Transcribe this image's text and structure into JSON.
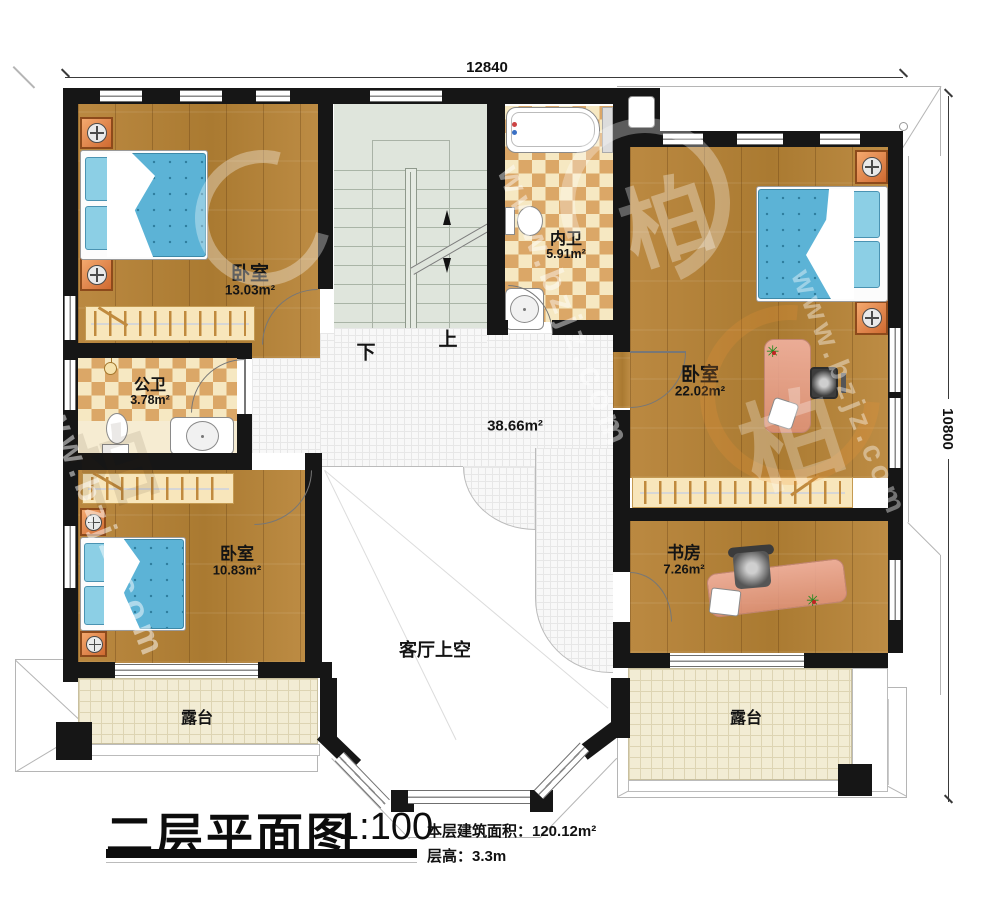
{
  "dimensions": {
    "width_top": "12840",
    "height_right": "10800"
  },
  "rooms": {
    "bedroom_tl": {
      "name": "卧室",
      "area": "13.03m²"
    },
    "bath_inner": {
      "name": "内卫",
      "area": "5.91m²"
    },
    "bedroom_right": {
      "name": "卧室",
      "area": "22.02m²"
    },
    "bath_public": {
      "name": "公卫",
      "area": "3.78m²"
    },
    "bedroom_mid": {
      "name": "卧室",
      "area": "10.83m²"
    },
    "study": {
      "name": "书房",
      "area": "7.26m²"
    },
    "hall": {
      "area": "38.66m²"
    },
    "void": {
      "name": "客厅上空"
    },
    "terrace_left": {
      "name": "露台"
    },
    "terrace_right": {
      "name": "露台"
    }
  },
  "stairs": {
    "down": "下",
    "up": "上"
  },
  "title": {
    "name": "二层平面图",
    "scale": "1:100",
    "area_line": "本层建筑面积：120.12m²",
    "height_line": "层高：3.3m"
  },
  "watermark": {
    "site": "www.bzjz.com",
    "logo": "柏"
  },
  "palette": {
    "wall": "#161616",
    "wood": "#b5823b",
    "checker": "#dba767",
    "stair": "#dfe5dc",
    "tile": "#f8f8f8",
    "terrace": "#f2ecd4",
    "bed_blue": "#5cb3d6",
    "pillow_blue": "#8ccfe5",
    "nightstand_orange": "#e78c52",
    "desk_pink": "#e8a795",
    "wardrobe_cream": "#f8e6bb"
  }
}
